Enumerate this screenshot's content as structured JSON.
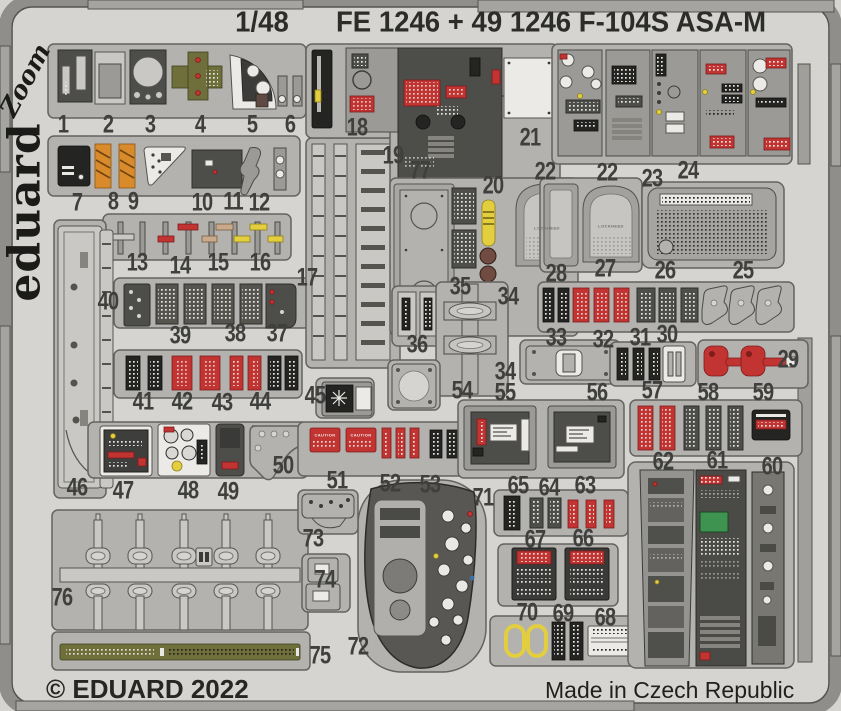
{
  "header": {
    "scale": "1/48",
    "title": "FE 1246 + 49 1246  F-104S ASA-M"
  },
  "branding": {
    "zoom_logo": "Zoom",
    "eduard_logo": "eduard"
  },
  "footer": {
    "copyright": "© EDUARD 2022",
    "made_in": "Made in Czech Republic"
  },
  "colors": {
    "sheet": "#d5d4d1",
    "fret": "#b3b2af",
    "label": "#3f3f3d",
    "red": "#c23432",
    "orange": "#d98b2b",
    "yellow": "#e2ce3e",
    "olive": "#6e6f3a"
  },
  "part_labels": [
    {
      "n": "1",
      "x": 63,
      "y": 125
    },
    {
      "n": "2",
      "x": 108,
      "y": 125
    },
    {
      "n": "3",
      "x": 150,
      "y": 125
    },
    {
      "n": "4",
      "x": 200,
      "y": 125
    },
    {
      "n": "5",
      "x": 252,
      "y": 125
    },
    {
      "n": "6",
      "x": 290,
      "y": 125
    },
    {
      "n": "7",
      "x": 77,
      "y": 203
    },
    {
      "n": "8",
      "x": 113,
      "y": 202
    },
    {
      "n": "9",
      "x": 133,
      "y": 202
    },
    {
      "n": "10",
      "x": 202,
      "y": 203
    },
    {
      "n": "11",
      "x": 233,
      "y": 202
    },
    {
      "n": "12",
      "x": 259,
      "y": 203
    },
    {
      "n": "13",
      "x": 137,
      "y": 263
    },
    {
      "n": "14",
      "x": 180,
      "y": 266
    },
    {
      "n": "15",
      "x": 218,
      "y": 263
    },
    {
      "n": "16",
      "x": 260,
      "y": 263
    },
    {
      "n": "17",
      "x": 307,
      "y": 278
    },
    {
      "n": "18",
      "x": 357,
      "y": 128
    },
    {
      "n": "19",
      "x": 393,
      "y": 156
    },
    {
      "n": "20",
      "x": 493,
      "y": 186
    },
    {
      "n": "21",
      "x": 530,
      "y": 138
    },
    {
      "n": "22",
      "x": 545,
      "y": 172
    },
    {
      "n": "22",
      "x": 607,
      "y": 173
    },
    {
      "n": "23",
      "x": 652,
      "y": 179
    },
    {
      "n": "24",
      "x": 688,
      "y": 171
    },
    {
      "n": "25",
      "x": 743,
      "y": 271
    },
    {
      "n": "26",
      "x": 665,
      "y": 271
    },
    {
      "n": "27",
      "x": 605,
      "y": 269
    },
    {
      "n": "28",
      "x": 556,
      "y": 274
    },
    {
      "n": "29",
      "x": 788,
      "y": 360
    },
    {
      "n": "30",
      "x": 667,
      "y": 335
    },
    {
      "n": "31",
      "x": 640,
      "y": 338
    },
    {
      "n": "32",
      "x": 603,
      "y": 340
    },
    {
      "n": "33",
      "x": 556,
      "y": 338
    },
    {
      "n": "34",
      "x": 508,
      "y": 297
    },
    {
      "n": "34",
      "x": 505,
      "y": 372
    },
    {
      "n": "35",
      "x": 460,
      "y": 287
    },
    {
      "n": "36",
      "x": 417,
      "y": 345
    },
    {
      "n": "37",
      "x": 277,
      "y": 334
    },
    {
      "n": "38",
      "x": 235,
      "y": 334
    },
    {
      "n": "39",
      "x": 180,
      "y": 336
    },
    {
      "n": "40",
      "x": 108,
      "y": 302
    },
    {
      "n": "41",
      "x": 143,
      "y": 402
    },
    {
      "n": "42",
      "x": 182,
      "y": 402
    },
    {
      "n": "43",
      "x": 222,
      "y": 403
    },
    {
      "n": "44",
      "x": 260,
      "y": 402
    },
    {
      "n": "45",
      "x": 315,
      "y": 396
    },
    {
      "n": "46",
      "x": 77,
      "y": 488
    },
    {
      "n": "47",
      "x": 123,
      "y": 491
    },
    {
      "n": "48",
      "x": 188,
      "y": 491
    },
    {
      "n": "49",
      "x": 228,
      "y": 492
    },
    {
      "n": "50",
      "x": 283,
      "y": 466
    },
    {
      "n": "51",
      "x": 337,
      "y": 481
    },
    {
      "n": "52",
      "x": 390,
      "y": 484
    },
    {
      "n": "53",
      "x": 430,
      "y": 485
    },
    {
      "n": "54",
      "x": 462,
      "y": 391
    },
    {
      "n": "55",
      "x": 505,
      "y": 393
    },
    {
      "n": "56",
      "x": 597,
      "y": 393
    },
    {
      "n": "57",
      "x": 652,
      "y": 391
    },
    {
      "n": "58",
      "x": 708,
      "y": 393
    },
    {
      "n": "59",
      "x": 763,
      "y": 393
    },
    {
      "n": "60",
      "x": 772,
      "y": 467
    },
    {
      "n": "61",
      "x": 717,
      "y": 461
    },
    {
      "n": "62",
      "x": 663,
      "y": 462
    },
    {
      "n": "63",
      "x": 585,
      "y": 486
    },
    {
      "n": "64",
      "x": 549,
      "y": 488
    },
    {
      "n": "65",
      "x": 518,
      "y": 486
    },
    {
      "n": "66",
      "x": 583,
      "y": 539
    },
    {
      "n": "67",
      "x": 535,
      "y": 540
    },
    {
      "n": "68",
      "x": 605,
      "y": 618
    },
    {
      "n": "69",
      "x": 563,
      "y": 614
    },
    {
      "n": "70",
      "x": 527,
      "y": 613
    },
    {
      "n": "71",
      "x": 483,
      "y": 498
    },
    {
      "n": "72",
      "x": 358,
      "y": 647
    },
    {
      "n": "73",
      "x": 313,
      "y": 539
    },
    {
      "n": "74",
      "x": 325,
      "y": 580
    },
    {
      "n": "75",
      "x": 320,
      "y": 656
    },
    {
      "n": "76",
      "x": 62,
      "y": 598
    },
    {
      "n": "77",
      "x": 420,
      "y": 171
    }
  ],
  "part_texts": [
    {
      "text": "LOCKHEED",
      "cls": "gray",
      "x": 547,
      "y": 228
    },
    {
      "text": "LOCKHEED",
      "cls": "gray",
      "x": 611,
      "y": 226
    },
    {
      "text": "CAUTION",
      "cls": "",
      "x": 325,
      "y": 435
    },
    {
      "text": "CAUTION",
      "cls": "",
      "x": 361,
      "y": 435
    }
  ]
}
